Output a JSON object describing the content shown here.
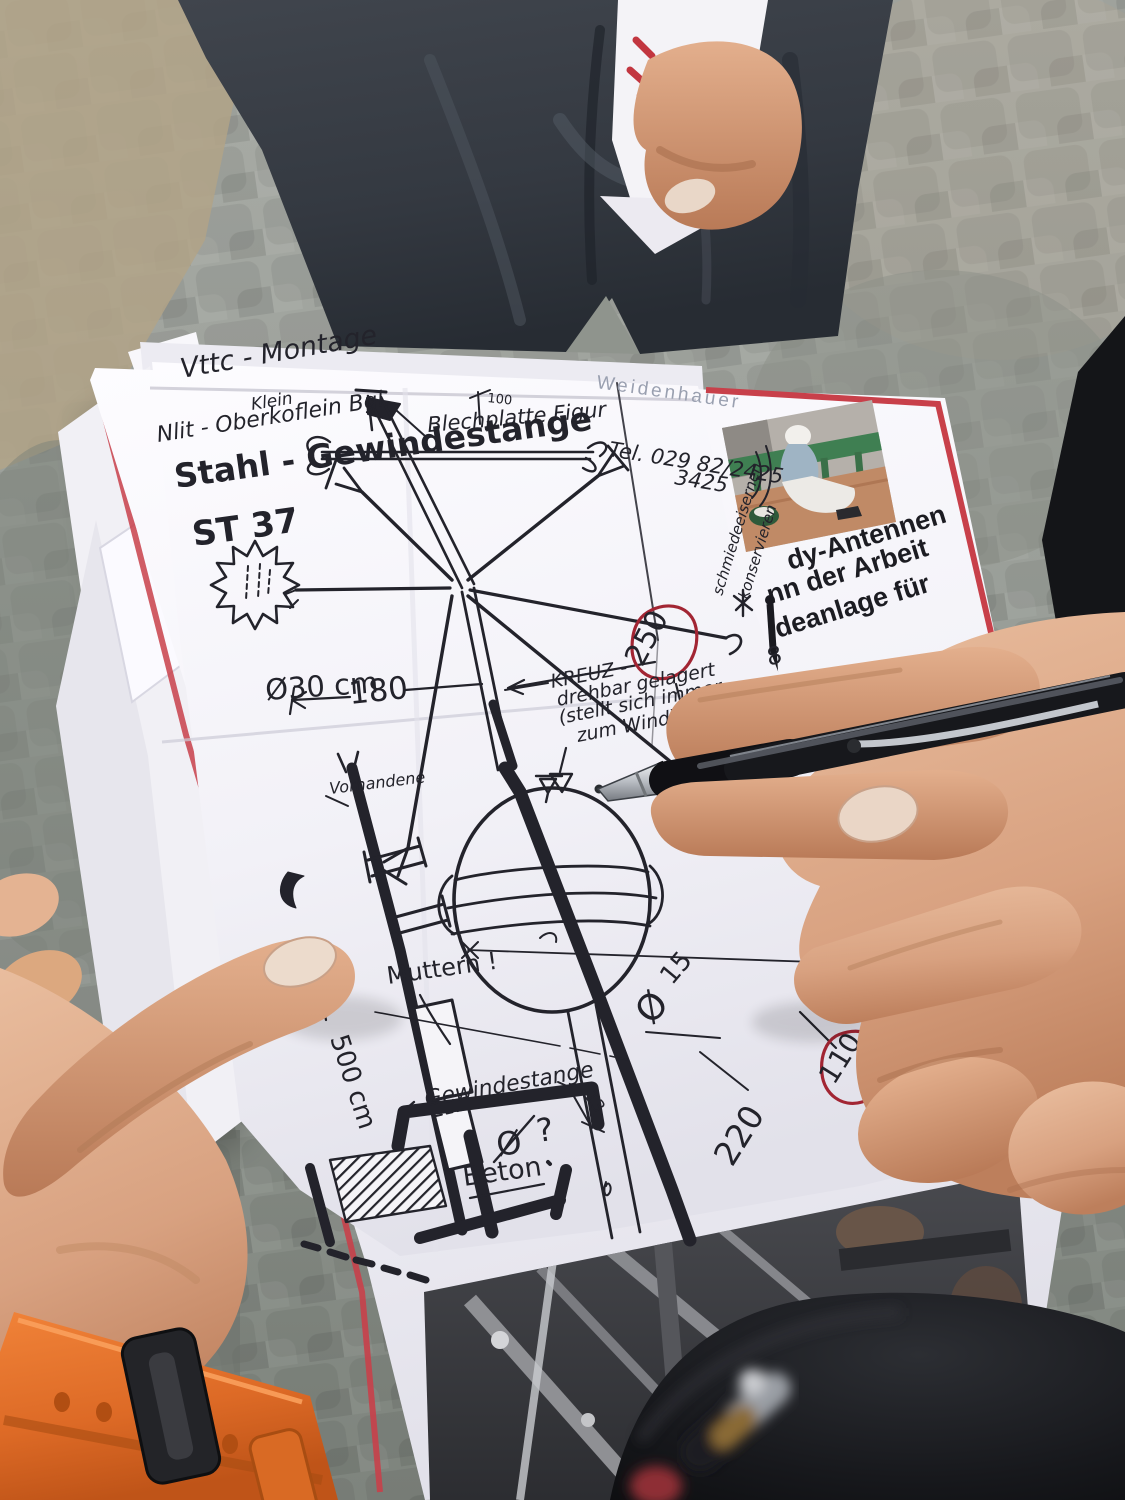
{
  "sketch": {
    "heading1": "Vttc - Montage",
    "heading2": "Klein",
    "heading3": "Nlit - Oberkoflein  Bgl.",
    "material1": "Stahl - Gewindestange",
    "material2": "ST 37",
    "blechplatte": "Blechplatte Figur",
    "tel1": "Tel. 029 82/2425",
    "tel2": "3425",
    "side_note1": "schmiedeeisernen",
    "side_note2": "konservieren",
    "kreuz1": "KREUZ -",
    "kreuz2": "drehbar gelagert",
    "kreuz3": "(stellt sich immer",
    "kreuz4": "zum Wind)",
    "d100": "100",
    "d180": "180",
    "d250": "250",
    "phi30": "Ø30 cm",
    "vorhanden": "Vorhandene",
    "muttern": "Muttern !",
    "d500": "500 cm",
    "gewindestange": "Gewindestange",
    "phi_q": "Ø",
    "q_mark": "?",
    "d13": "13",
    "beton": "Beton",
    "phi15_sym": "Ø",
    "phi15_val": "15",
    "d220": "220",
    "d110": "110",
    "mark8": "8"
  },
  "flyer": {
    "header_faint": "Weidenhauer",
    "line1": "dy-Antennen",
    "line2": "nn der Arbeit",
    "line3": "deanlage für",
    "d40": "40"
  },
  "colors": {
    "ink": "#23232b",
    "flyer_border_red": "#c8404a",
    "annotation_red": "#a22533",
    "watch_orange": "#e2702a",
    "paper": "#f5f4f8"
  }
}
